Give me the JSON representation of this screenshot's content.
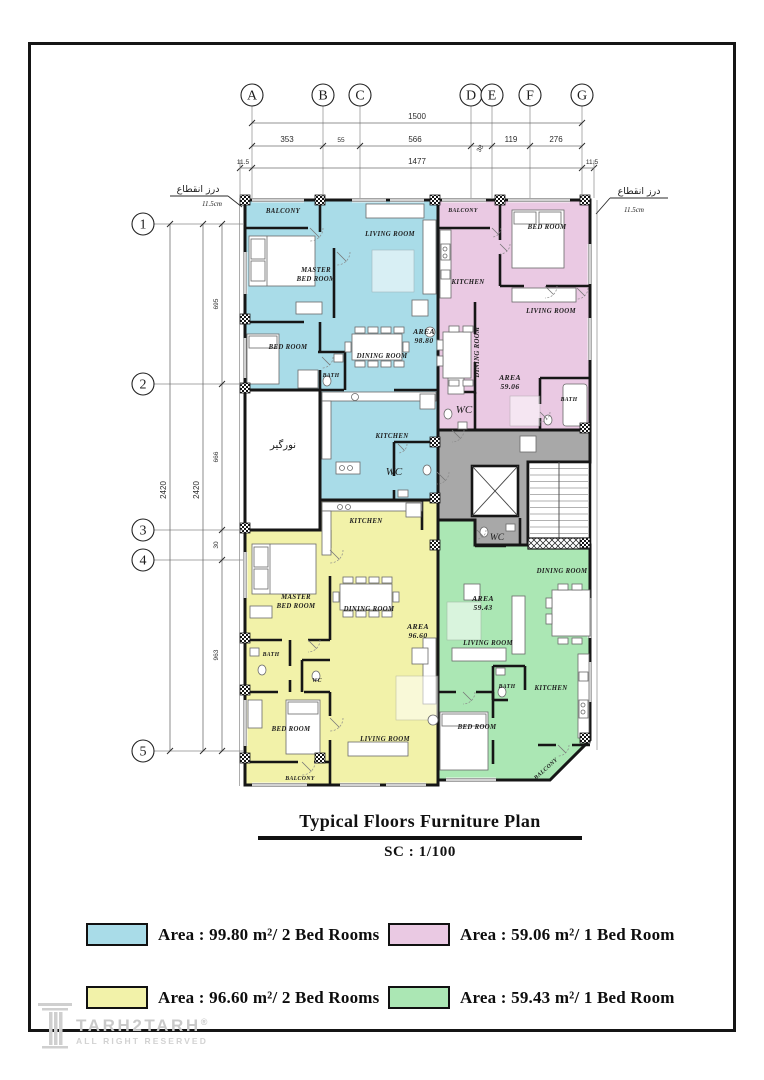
{
  "sheet": {
    "bg": "#ffffff",
    "border_color": "#151515"
  },
  "grid": {
    "columns": [
      "A",
      "B",
      "C",
      "D",
      "E",
      "F",
      "G"
    ],
    "rows": [
      "1",
      "2",
      "3",
      "4",
      "5"
    ],
    "top_dims": {
      "overall": "1500",
      "segments": [
        "353",
        "55",
        "566",
        "38",
        "119",
        "276"
      ],
      "inner": [
        "11.5",
        "1477",
        "11.5"
      ]
    },
    "left_dims": {
      "overall": [
        "2420",
        "2420"
      ],
      "segments": [
        "695",
        "666",
        "30",
        "963"
      ]
    }
  },
  "joints": {
    "left": {
      "label": "درز انقطاع",
      "value": "11.5cm"
    },
    "right": {
      "label": "درز انقطاع",
      "value": "11.5cm"
    }
  },
  "plan": {
    "colors": {
      "unit_blue": "#a9dce8",
      "unit_pink": "#eac9e3",
      "unit_yellow": "#f2f2a9",
      "unit_green": "#abe7b4",
      "core_gray": "#a8a8a8",
      "wall": "#161616"
    },
    "labels": [
      {
        "text": "BALCONY",
        "x": 283,
        "y": 213,
        "cls": "room-lb"
      },
      {
        "text": "LIVING ROOM",
        "x": 390,
        "y": 236,
        "cls": "room-lb"
      },
      {
        "text": "MASTER",
        "x": 316,
        "y": 272,
        "cls": "room-lb"
      },
      {
        "text": "BED ROOM",
        "x": 316,
        "y": 281,
        "cls": "room-lb"
      },
      {
        "text": "BED ROOM",
        "x": 288,
        "y": 349,
        "cls": "room-lb"
      },
      {
        "text": "BATH",
        "x": 331,
        "y": 377,
        "cls": "room-lb",
        "size": 5.8
      },
      {
        "text": "DINING ROOM",
        "x": 382,
        "y": 358,
        "cls": "room-lb"
      },
      {
        "text": "AREA",
        "x": 424,
        "y": 334,
        "cls": "area-lb"
      },
      {
        "text": "98.80",
        "x": 424,
        "y": 343,
        "cls": "area-lb"
      },
      {
        "text": "KITCHEN",
        "x": 392,
        "y": 438,
        "cls": "room-lb"
      },
      {
        "text": "WC",
        "x": 394,
        "y": 475,
        "cls": "wc-lb"
      },
      {
        "text": "نورگیر",
        "x": 283,
        "y": 448,
        "cls": "ar-lb"
      },
      {
        "text": "BALCONY",
        "x": 463,
        "y": 212,
        "cls": "room-lb",
        "size": 5.8
      },
      {
        "text": "BED ROOM",
        "x": 547,
        "y": 229,
        "cls": "room-lb"
      },
      {
        "text": "KITCHEN",
        "x": 468,
        "y": 284,
        "cls": "room-lb"
      },
      {
        "text": "LIVING ROOM",
        "x": 551,
        "y": 313,
        "cls": "room-lb"
      },
      {
        "text": "DINING ROOM",
        "x": 479,
        "y": 352,
        "cls": "room-lb",
        "rot": -90
      },
      {
        "text": "AREA",
        "x": 510,
        "y": 380,
        "cls": "area-lb"
      },
      {
        "text": "59.06",
        "x": 510,
        "y": 389,
        "cls": "area-lb"
      },
      {
        "text": "WC",
        "x": 464,
        "y": 413,
        "cls": "wc-lb"
      },
      {
        "text": "BATH",
        "x": 569,
        "y": 401,
        "cls": "room-lb",
        "size": 5.8
      },
      {
        "text": "KITCHEN",
        "x": 366,
        "y": 523,
        "cls": "room-lb"
      },
      {
        "text": "MASTER",
        "x": 296,
        "y": 599,
        "cls": "room-lb"
      },
      {
        "text": "BED ROOM",
        "x": 296,
        "y": 608,
        "cls": "room-lb"
      },
      {
        "text": "DINING ROOM",
        "x": 369,
        "y": 611,
        "cls": "room-lb"
      },
      {
        "text": "AREA",
        "x": 418,
        "y": 629,
        "cls": "area-lb"
      },
      {
        "text": "96.60",
        "x": 418,
        "y": 638,
        "cls": "area-lb"
      },
      {
        "text": "BATH",
        "x": 271,
        "y": 656,
        "cls": "room-lb",
        "size": 5.8
      },
      {
        "text": "WC",
        "x": 317,
        "y": 682,
        "cls": "room-lb",
        "size": 5.8
      },
      {
        "text": "BED ROOM",
        "x": 291,
        "y": 731,
        "cls": "room-lb"
      },
      {
        "text": "LIVING ROOM",
        "x": 385,
        "y": 741,
        "cls": "room-lb"
      },
      {
        "text": "BALCONY",
        "x": 300,
        "y": 780,
        "cls": "room-lb",
        "size": 5.8
      },
      {
        "text": "WC",
        "x": 497,
        "y": 540,
        "cls": "wc-lb",
        "size": 9.5
      },
      {
        "text": "DINING ROOM",
        "x": 562,
        "y": 573,
        "cls": "room-lb"
      },
      {
        "text": "AREA",
        "x": 483,
        "y": 601,
        "cls": "area-lb"
      },
      {
        "text": "59.43",
        "x": 483,
        "y": 610,
        "cls": "area-lb"
      },
      {
        "text": "LIVING ROOM",
        "x": 488,
        "y": 645,
        "cls": "room-lb"
      },
      {
        "text": "BATH",
        "x": 507,
        "y": 688,
        "cls": "room-lb",
        "size": 5.8
      },
      {
        "text": "KITCHEN",
        "x": 551,
        "y": 690,
        "cls": "room-lb"
      },
      {
        "text": "BED ROOM",
        "x": 477,
        "y": 729,
        "cls": "room-lb"
      },
      {
        "text": "BALCONY",
        "x": 547,
        "y": 770,
        "cls": "room-lb",
        "size": 5.8,
        "rot": -42
      }
    ]
  },
  "title_block": {
    "title": "Typical Floors Furniture Plan",
    "scale": "SC : 1/100"
  },
  "legend": {
    "items": [
      {
        "color": "#a9dce8",
        "label": "Area : 99.80 m²/ 2 Bed Rooms"
      },
      {
        "color": "#eac9e3",
        "label": "Area : 59.06 m²/ 1 Bed Room"
      },
      {
        "color": "#f2f2a9",
        "label": "Area : 96.60 m²/ 2 Bed Rooms"
      },
      {
        "color": "#abe7b4",
        "label": "Area : 59.43 m²/ 1 Bed Room"
      }
    ]
  },
  "logo": {
    "brand": "TARH2TARH",
    "reg": "®",
    "tagline": "ALL RIGHT RESERVED"
  }
}
